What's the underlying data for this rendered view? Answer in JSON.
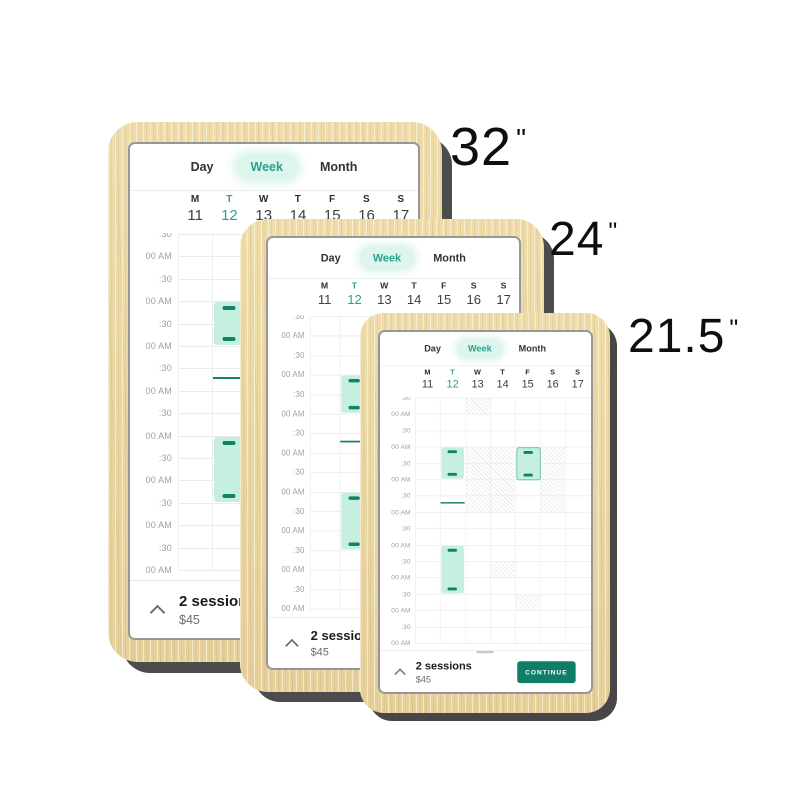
{
  "devices": [
    {
      "name": "32-inch-display",
      "size": "32",
      "unit": "\""
    },
    {
      "name": "24-inch-display",
      "size": "24",
      "unit": "\""
    },
    {
      "name": "21.5-inch-display",
      "size": "21.5",
      "unit": "\""
    }
  ],
  "app": {
    "tabs": [
      {
        "label": "Day",
        "active": false
      },
      {
        "label": "Week",
        "active": true
      },
      {
        "label": "Month",
        "active": false
      }
    ],
    "days": [
      {
        "label": "M",
        "date": "11",
        "active": false
      },
      {
        "label": "T",
        "date": "12",
        "active": true
      },
      {
        "label": "W",
        "date": "13",
        "active": false
      },
      {
        "label": "T",
        "date": "14",
        "active": false
      },
      {
        "label": "F",
        "date": "15",
        "active": false
      },
      {
        "label": "S",
        "date": "16",
        "active": false
      },
      {
        "label": "S",
        "date": "17",
        "active": false
      }
    ],
    "grid": {
      "time_labels": [
        ":30",
        "00 AM",
        ":30",
        "00 AM",
        ":30",
        "00 AM",
        ":30",
        "00 AM",
        ":30",
        "00 AM",
        ":30",
        "00 AM",
        ":30",
        "00 AM",
        ":30",
        "00 AM"
      ],
      "slots": 15,
      "sessions": [
        {
          "day": 1,
          "start": 3,
          "span": 2,
          "bordered": false
        },
        {
          "day": 4,
          "start": 3,
          "span": 2,
          "bordered": true
        },
        {
          "day": 1,
          "start": 9,
          "span": 3,
          "bordered": false
        }
      ],
      "availability_lines": [
        {
          "day": 1,
          "at": 6.4
        }
      ],
      "unavailable": [
        {
          "day": 2,
          "start": 0,
          "span": 1,
          "cols": 1
        },
        {
          "day": 2,
          "start": 3,
          "span": 4,
          "cols": 2
        },
        {
          "day": 5,
          "start": 3,
          "span": 4,
          "cols": 1
        },
        {
          "day": 3,
          "start": 10,
          "span": 1,
          "cols": 1
        },
        {
          "day": 4,
          "start": 12,
          "span": 1,
          "cols": 1
        }
      ]
    },
    "footer": {
      "sessions_label": "2 sessions",
      "price": "$45",
      "continue_label": "CONTINUE"
    }
  },
  "colors": {
    "accent": "#2aa18c",
    "accent_dark": "#0e7e67",
    "session_fill": "#c5f0e0",
    "session_handle": "#14806a",
    "availability_line": "#1c7f6e",
    "pill_bg": "#def5ee",
    "wood": "#e9d5a6",
    "shadow": "#4c4c4c"
  }
}
